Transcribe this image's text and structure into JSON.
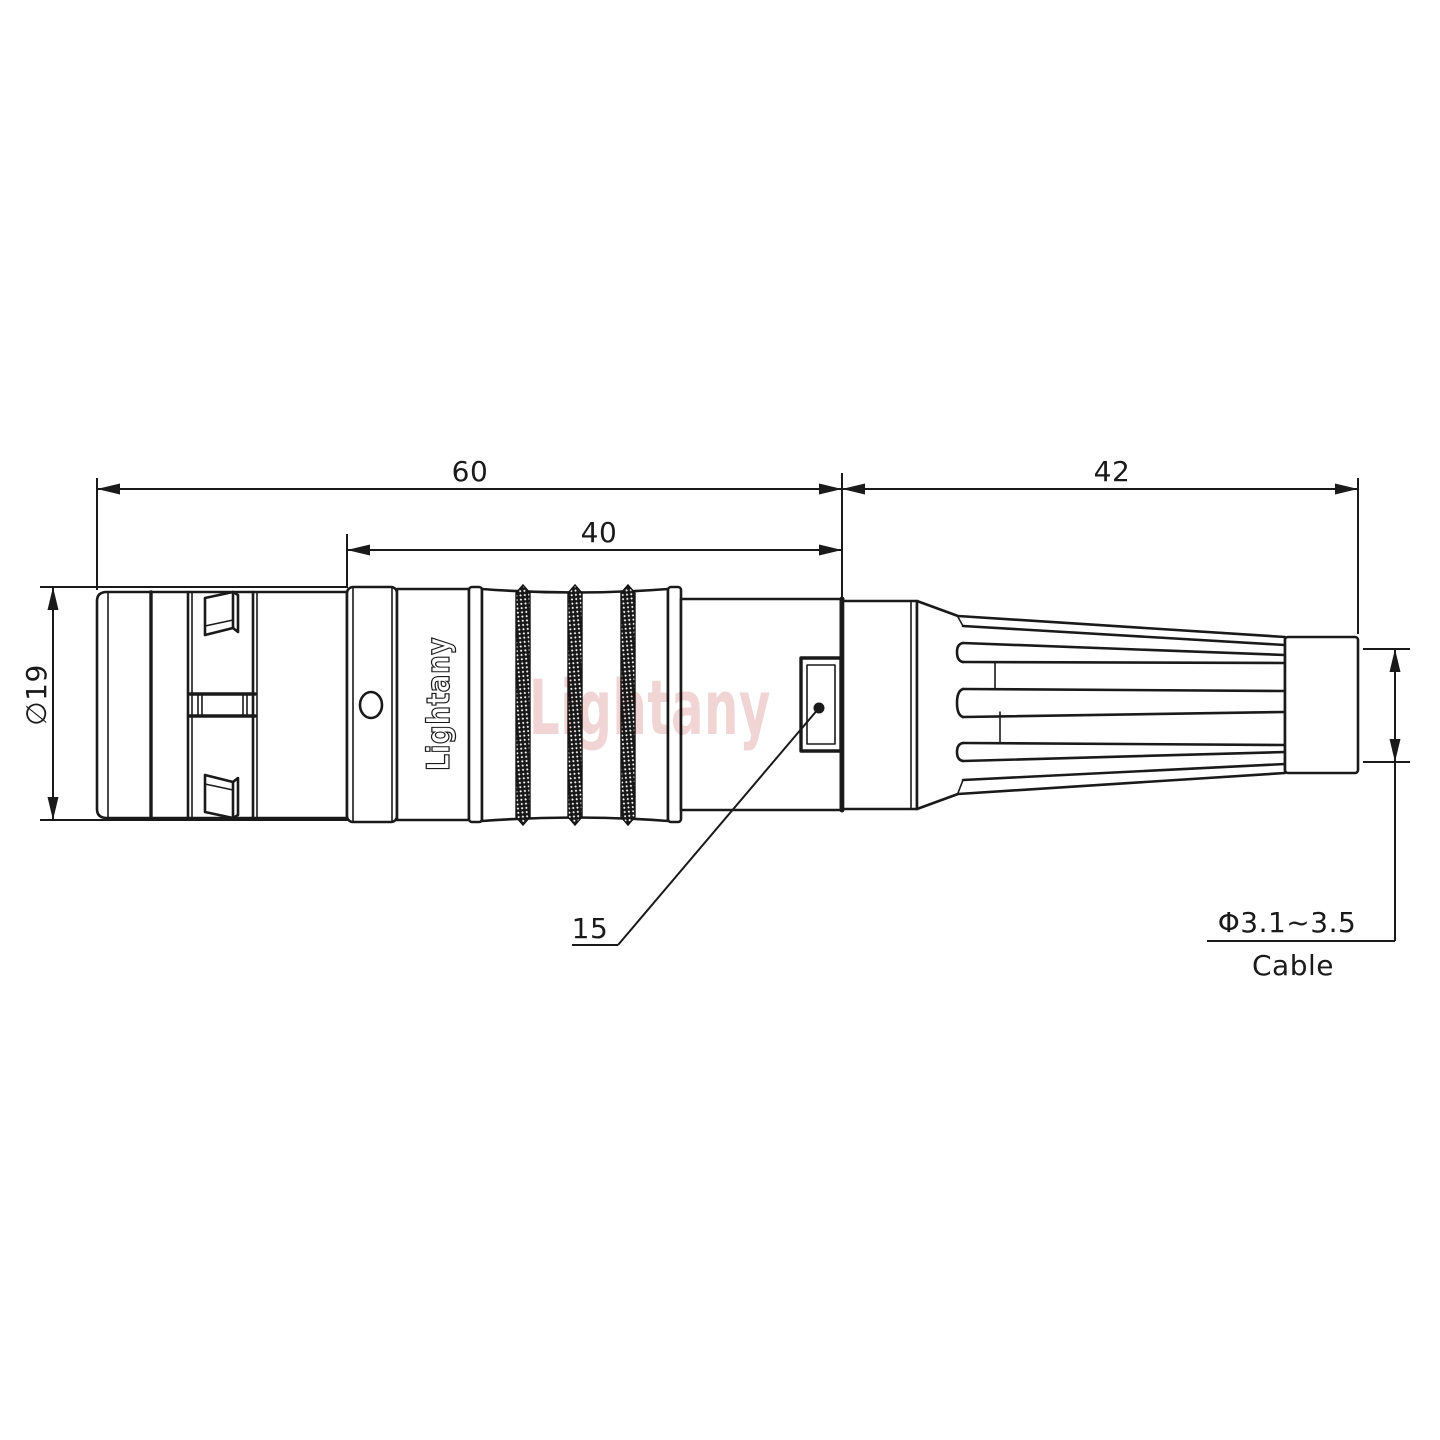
{
  "drawing": {
    "dimensions": {
      "overall_length": "60",
      "mid_length": "40",
      "boot_length": "42",
      "shell_diameter": "∅19",
      "latch_ref": "15",
      "cable_diameter": "Φ3.1~3.5",
      "cable_label": "Cable"
    },
    "branding": {
      "watermark": "Lightany",
      "engraving": "Lightany"
    },
    "colors": {
      "line": "#1a1a1a",
      "watermark_pink": "#dfa0a0",
      "background": "#ffffff"
    }
  }
}
